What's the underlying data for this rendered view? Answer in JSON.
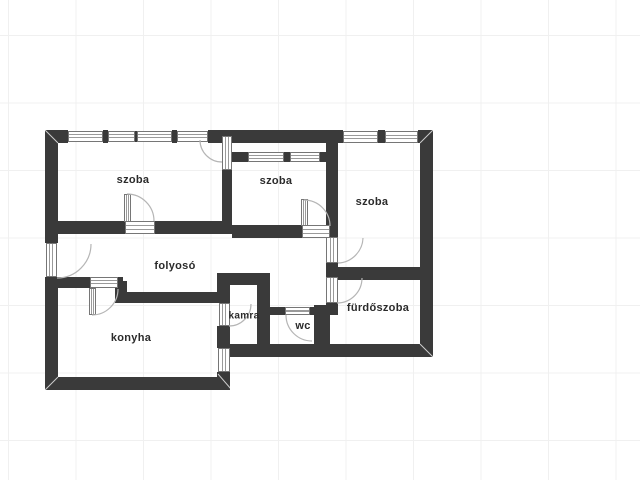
{
  "plan": {
    "rooms": [
      {
        "id": "szoba-1",
        "label": "szoba"
      },
      {
        "id": "szoba-2",
        "label": "szoba"
      },
      {
        "id": "szoba-3",
        "label": "szoba"
      },
      {
        "id": "folyoso",
        "label": "folyosó"
      },
      {
        "id": "konyha",
        "label": "konyha"
      },
      {
        "id": "kamra",
        "label": "kamra"
      },
      {
        "id": "wc",
        "label": "wc"
      },
      {
        "id": "furdoszoba",
        "label": "fürdőszoba"
      }
    ],
    "colors": {
      "wall": "#3a3a3a",
      "canvas_background": "#ffffff",
      "grid_line": "#f0f0f0",
      "window_frame": "#767676",
      "door_swing_arc": "#b5b5b5"
    }
  }
}
